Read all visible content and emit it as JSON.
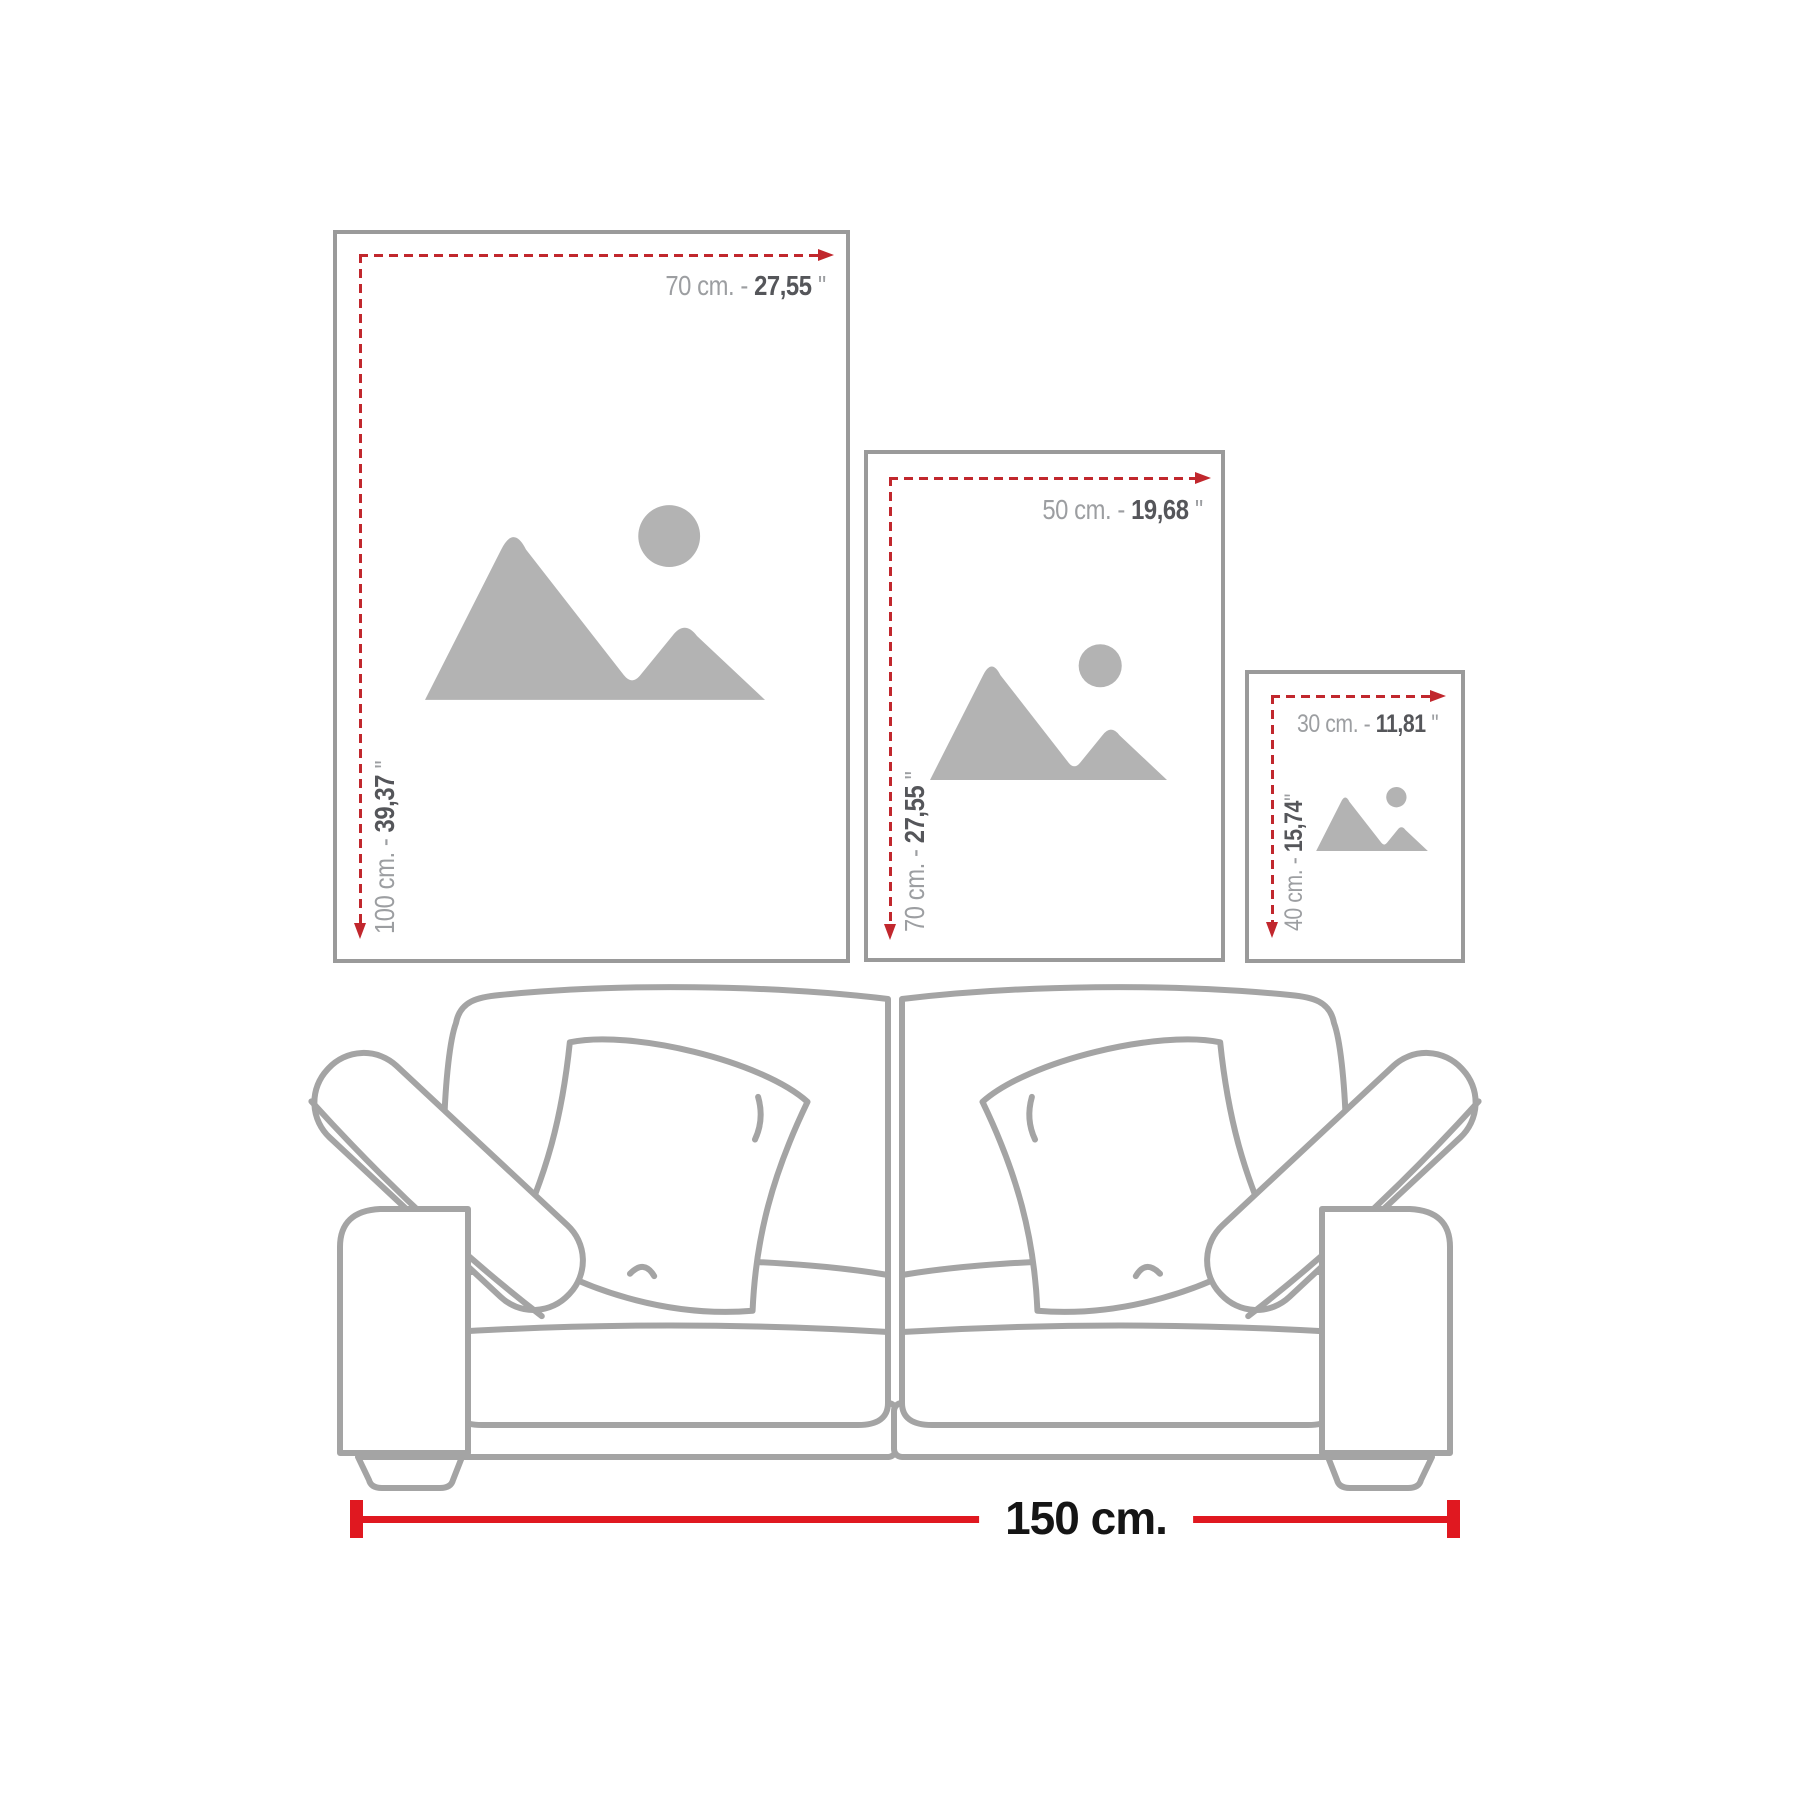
{
  "frames": [
    {
      "name": "large",
      "w_prefix": "70 cm. - ",
      "w_value": "27,55",
      "w_suffix": " ''",
      "h_prefix": "100 cm. - ",
      "h_value": "39,37",
      "h_suffix": " ''"
    },
    {
      "name": "medium",
      "w_prefix": "50 cm. - ",
      "w_value": "19,68",
      "w_suffix": " ''",
      "h_prefix": "70 cm. - ",
      "h_value": "27,55",
      "h_suffix": " ''"
    },
    {
      "name": "small",
      "w_prefix": "30 cm. - ",
      "w_value": "11,81",
      "w_suffix": " ''",
      "h_prefix": "40 cm. - ",
      "h_value": "15,74",
      "h_suffix": "''"
    }
  ],
  "sofa": {
    "width_label": "150 cm."
  },
  "colors": {
    "dimension_red_dashed": "#c1272d",
    "measure_red_solid": "#e01820",
    "frame_border_gray": "#9a9a9a",
    "placeholder_icon_gray": "#b3b3b3",
    "sofa_line_gray": "#a4a4a4",
    "label_light_gray": "#9c9ea1",
    "label_dark_gray": "#55565a",
    "measure_text_black": "#151515"
  }
}
